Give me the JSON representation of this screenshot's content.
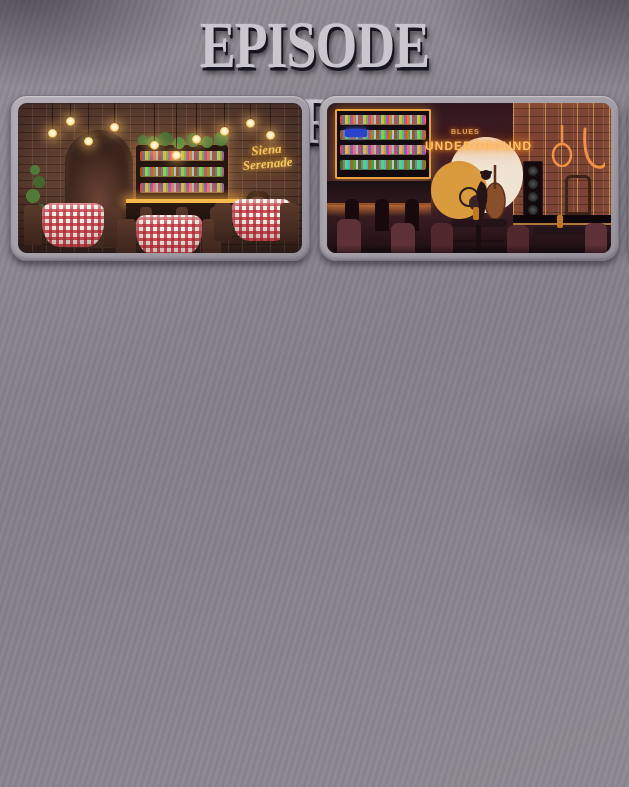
{
  "title": "EPISODE BACKGROUNDS",
  "palette": {
    "wall_concrete": "#8a868e",
    "frame": "#a49ea7",
    "title_silver": "#c9c6cd",
    "neon_gold": "#f2c760",
    "neon_orange": "#ffc069",
    "neon_pink": "#ff8fd0",
    "neon_blue": "#bcd9ea"
  },
  "cards": [
    {
      "name": "italian-trattoria",
      "sign_line1": "Siena",
      "sign_line2": "Serenade"
    },
    {
      "name": "jazz-club",
      "sign_top": "BLUES",
      "sign": "UNDERGROUND"
    },
    {
      "name": "cellar-door-pizzeria",
      "sign_line1": "CELLAR",
      "sign_line2": "DOOR"
    },
    {
      "name": "cup-of-dreams-cafe",
      "sign_word": "CUP",
      "sign_tail": "of dreams"
    },
    {
      "name": "blue-teen-bedroom"
    },
    {
      "name": "black-white-city-bedroom"
    },
    {
      "name": "pink-grace-bedroom",
      "sign": "Grace"
    },
    {
      "name": "cozy-neutral-bedroom",
      "sign_line1": "keep calm,",
      "sign_line2": "stay loved"
    }
  ]
}
